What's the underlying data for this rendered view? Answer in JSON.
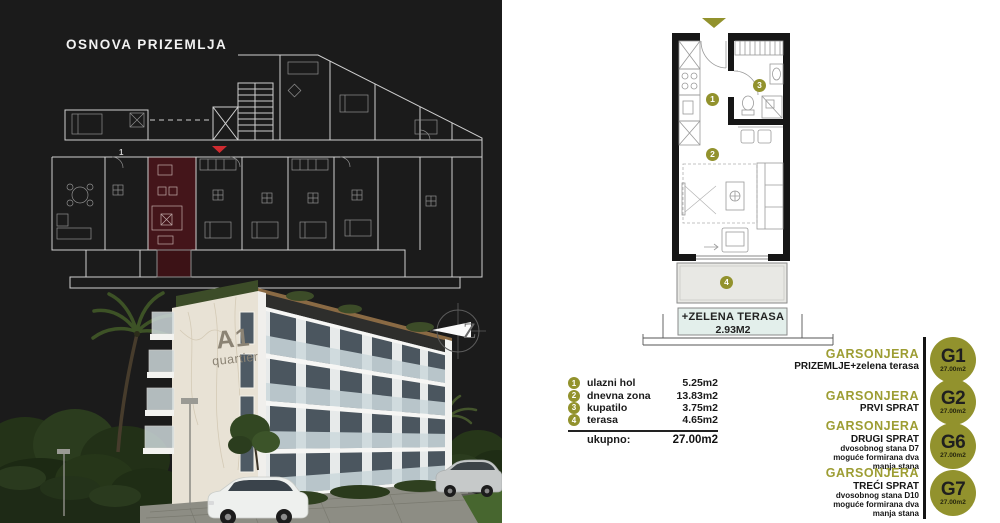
{
  "left_panel": {
    "title": "OSNOVA PRIZEMLJA",
    "brand_line1": "A1",
    "brand_line2": "quartier",
    "compass_letter": "Z",
    "highlight_unit_number": "1"
  },
  "unit_plan": {
    "markers": {
      "m1": "1",
      "m2": "2",
      "m3": "3",
      "m4": "4"
    },
    "terrace_label": "+ZELENA TERASA",
    "terrace_area": "2.93M2"
  },
  "legend": {
    "rows": [
      {
        "num": "1",
        "label": "ulazni hol",
        "area": "5.25m2"
      },
      {
        "num": "2",
        "label": "dnevna zona",
        "area": "13.83m2"
      },
      {
        "num": "3",
        "label": "kupatilo",
        "area": "3.75m2"
      },
      {
        "num": "4",
        "label": "terasa",
        "area": "4.65m2"
      }
    ],
    "total_label": "ukupno:",
    "total_area": "27.00m2"
  },
  "units": [
    {
      "code": "G1",
      "area": "27.00m2",
      "name": "GARSONJERA",
      "floor": "PRIZEMLJE+zelena terasa"
    },
    {
      "code": "G2",
      "area": "27.00m2",
      "name": "GARSONJERA",
      "floor": "PRVI SPRAT"
    },
    {
      "code": "G6",
      "area": "27.00m2",
      "name": "GARSONJERA",
      "floor": "DRUGI SPRAT",
      "note1": "dvosobnog stana D7",
      "note2": "moguće formirana dva",
      "note3": "manja stana"
    },
    {
      "code": "G7",
      "area": "27.00m2",
      "name": "GARSONJERA",
      "floor": "TREĆI SPRAT",
      "note1": "dvosobnog stana D10",
      "note2": "moguće formirana dva",
      "note3": "manja stana"
    }
  ],
  "colors": {
    "olive": "#92922d",
    "highlight_red": "#cf2b30",
    "unit_fill": "#44151a",
    "panel_dark": "#1b1b1b",
    "terrace_fill": "#e8e8e4",
    "green_terrace_fill": "#e3efeb"
  }
}
